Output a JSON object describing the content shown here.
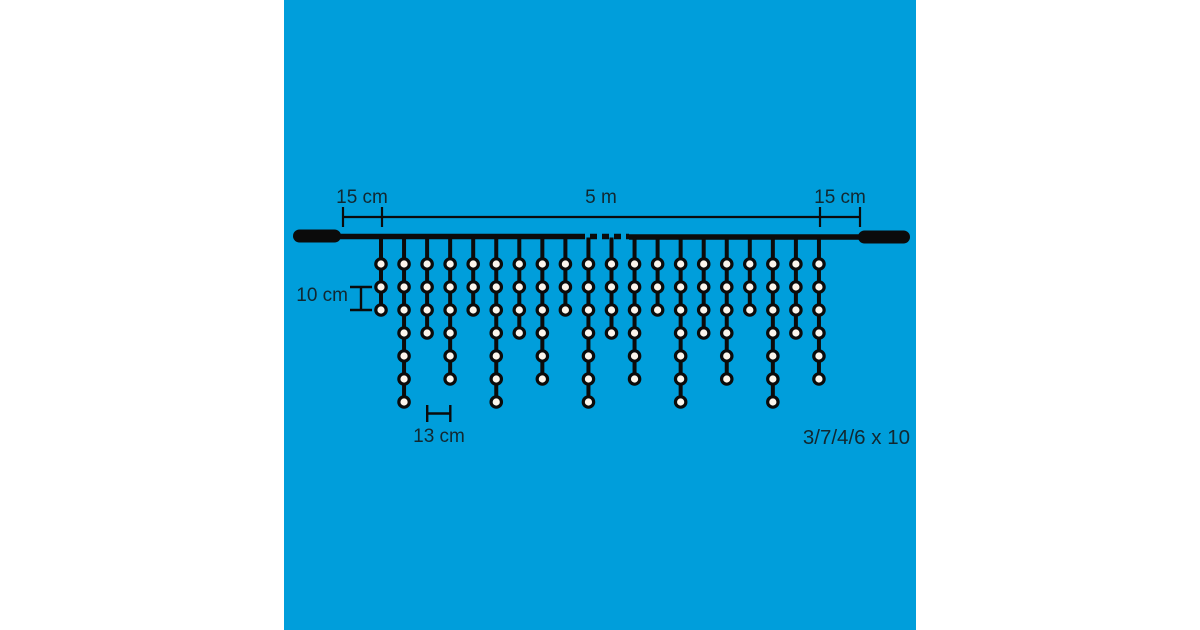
{
  "colors": {
    "background": "#ffffff",
    "panel": "#009EDB",
    "line": "#0B0B0B",
    "bulb_fill": "#FBF5EC",
    "text": "#112831"
  },
  "diagram": {
    "labels": {
      "lead_left": "15 cm",
      "span": "5 m",
      "lead_right": "15 cm",
      "bulb_spacing": "10 cm",
      "drop_spacing": "13 cm",
      "pattern": "3/7/4/6 x 10"
    },
    "pattern_counts": [
      3,
      7,
      4,
      6
    ],
    "strand_bulb_counts": [
      3,
      7,
      4,
      6,
      3,
      7,
      4,
      6,
      3,
      7,
      4,
      6,
      3,
      7,
      4,
      6,
      3,
      7,
      4,
      6
    ]
  }
}
